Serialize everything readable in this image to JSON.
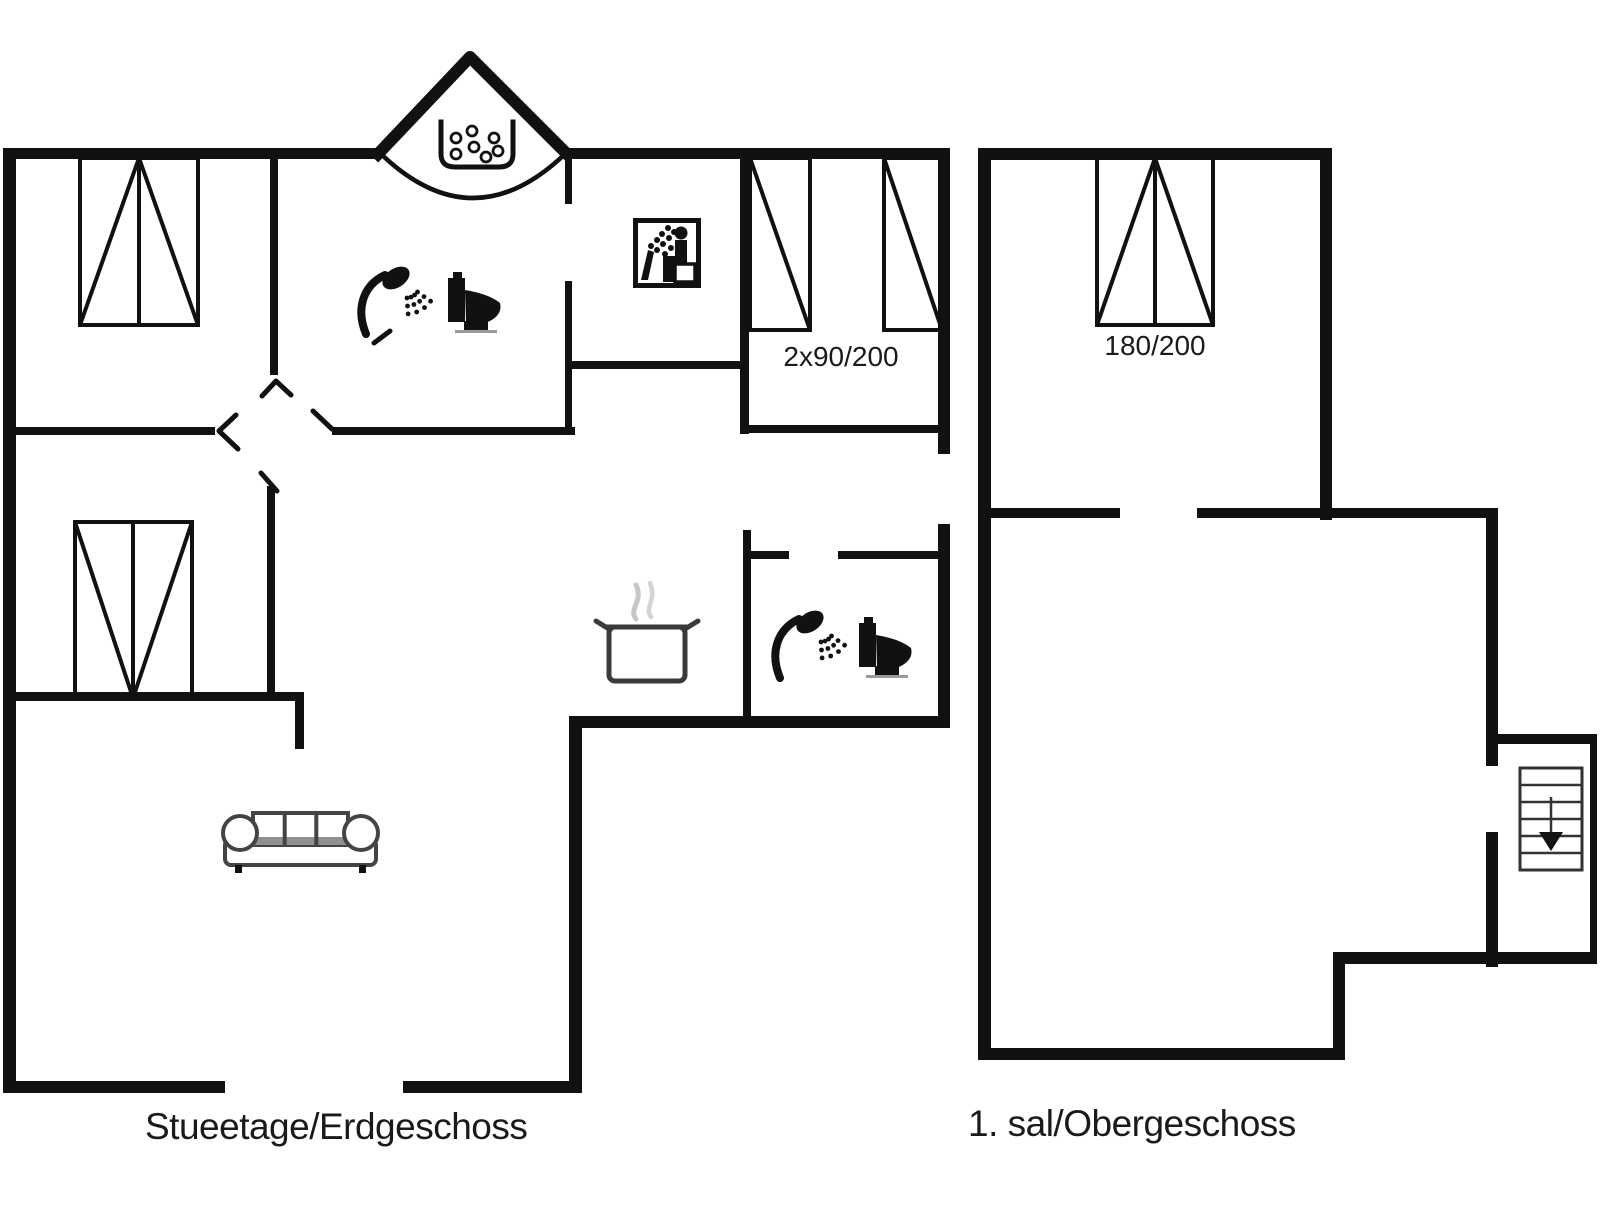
{
  "colors": {
    "background": "#ffffff",
    "walls": "#111111",
    "thin_lines": "#111111",
    "text": "#1a1a1a",
    "steam": "#c6c6c6",
    "sofa_shade": "#909090"
  },
  "floor_plans": {
    "ground_floor": {
      "name_label": "Stueetage/Erdgeschoss",
      "bed_size_label": "2x90/200",
      "icons": [
        "whirlpool-tub",
        "shower",
        "toilet",
        "sauna",
        "cooking-pot",
        "shower",
        "toilet",
        "sofa",
        "double-bed",
        "double-bed",
        "single-bed",
        "single-bed"
      ]
    },
    "upper_floor": {
      "name_label": "1. sal/Obergeschoss",
      "bed_size_label": "180/200",
      "icons": [
        "double-bed",
        "stairs-down"
      ]
    }
  }
}
